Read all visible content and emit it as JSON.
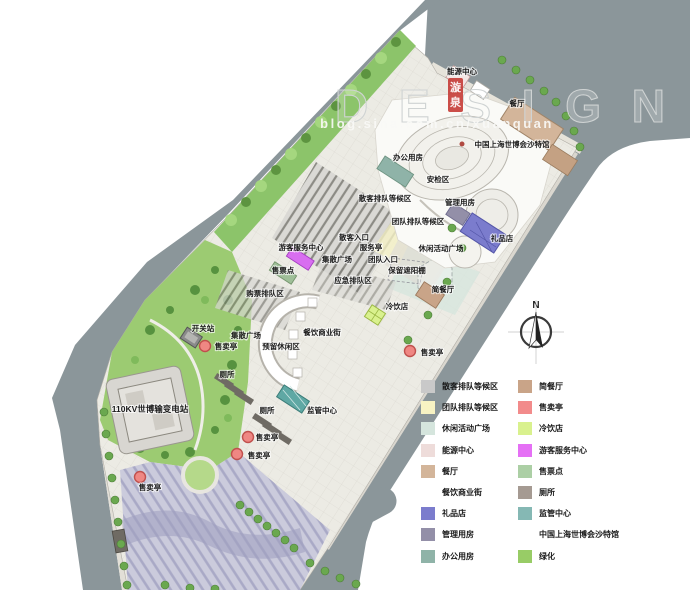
{
  "watermark": {
    "title": "DESIGN",
    "subtitle": "blog.sina.com.cn/xuanquan"
  },
  "stamp": {
    "char1": "漩",
    "char2": "泉",
    "color": "#c53b35"
  },
  "compass": {
    "north_label": "N"
  },
  "map_labels": {
    "energy_center": "能源中心",
    "restaurant": "餐厅",
    "pavilion": "中国上海世博会沙特馆",
    "office": "办公用房",
    "security_area": "安检区",
    "individual_queue": "散客排队等候区",
    "management": "管理用房",
    "group_queue": "团队排队等候区",
    "individual_entrance": "散客入口",
    "gift_shop": "礼品店",
    "service_kiosk": "服务亭",
    "leisure_plaza": "休闲活动广场",
    "visitor_center": "游客服务中心",
    "gather_plaza_a": "集散广场",
    "group_entrance": "团队入口",
    "canopy": "保留遮阳棚",
    "ticket_point": "售票点",
    "emergency_queue": "应急排队区",
    "ticket_queue": "购票排队区",
    "snack_bar": "简餐厅",
    "cold_drink": "冷饮店",
    "switch_station": "开关站",
    "gather_plaza_b": "集散广场",
    "food_street": "餐饮商业街",
    "reserved_leisure": "预留休闲区",
    "kiosk": "售卖亭",
    "toilet": "厕所",
    "substation": "110KV世博输变电站",
    "supervision": "监管中心"
  },
  "legend": {
    "left": [
      {
        "label": "散客排队等候区",
        "color": "#c9c9c9"
      },
      {
        "label": "团队排队等候区",
        "color": "#f8f3c3"
      },
      {
        "label": "休闲活动广场",
        "color": "#d5e5dd"
      },
      {
        "label": "能源中心",
        "color": "#eedcda"
      },
      {
        "label": "餐厅",
        "color": "#d3b59a"
      },
      {
        "label": "餐饮商业街",
        "color": null
      },
      {
        "label": "礼品店",
        "color": "#7b7ccd"
      },
      {
        "label": "管理用房",
        "color": "#938fa8"
      },
      {
        "label": "办公用房",
        "color": "#8fb3a8"
      }
    ],
    "right": [
      {
        "label": "简餐厅",
        "color": "#c9a488"
      },
      {
        "label": "售卖亭",
        "color": "#f28b8b"
      },
      {
        "label": "冷饮店",
        "color": "#d9f18e"
      },
      {
        "label": "游客服务中心",
        "color": "#e570f5"
      },
      {
        "label": "售票点",
        "color": "#accfa5"
      },
      {
        "label": "厕所",
        "color": "#a59a92"
      },
      {
        "label": "监管中心",
        "color": "#85b8b4"
      },
      {
        "label": "中国上海世博会沙特馆",
        "color": null
      },
      {
        "label": "绿化",
        "color": "#98cc66"
      }
    ]
  },
  "colors": {
    "road": "#8b969a",
    "sidewalk": "#e2dfd7",
    "site_paving": "#ecebe4",
    "park_green": "#9ccb72",
    "strip_green": "#8cc46a",
    "striped_pavement": "#c8c8da",
    "kiosk_red": "#ef8783"
  }
}
